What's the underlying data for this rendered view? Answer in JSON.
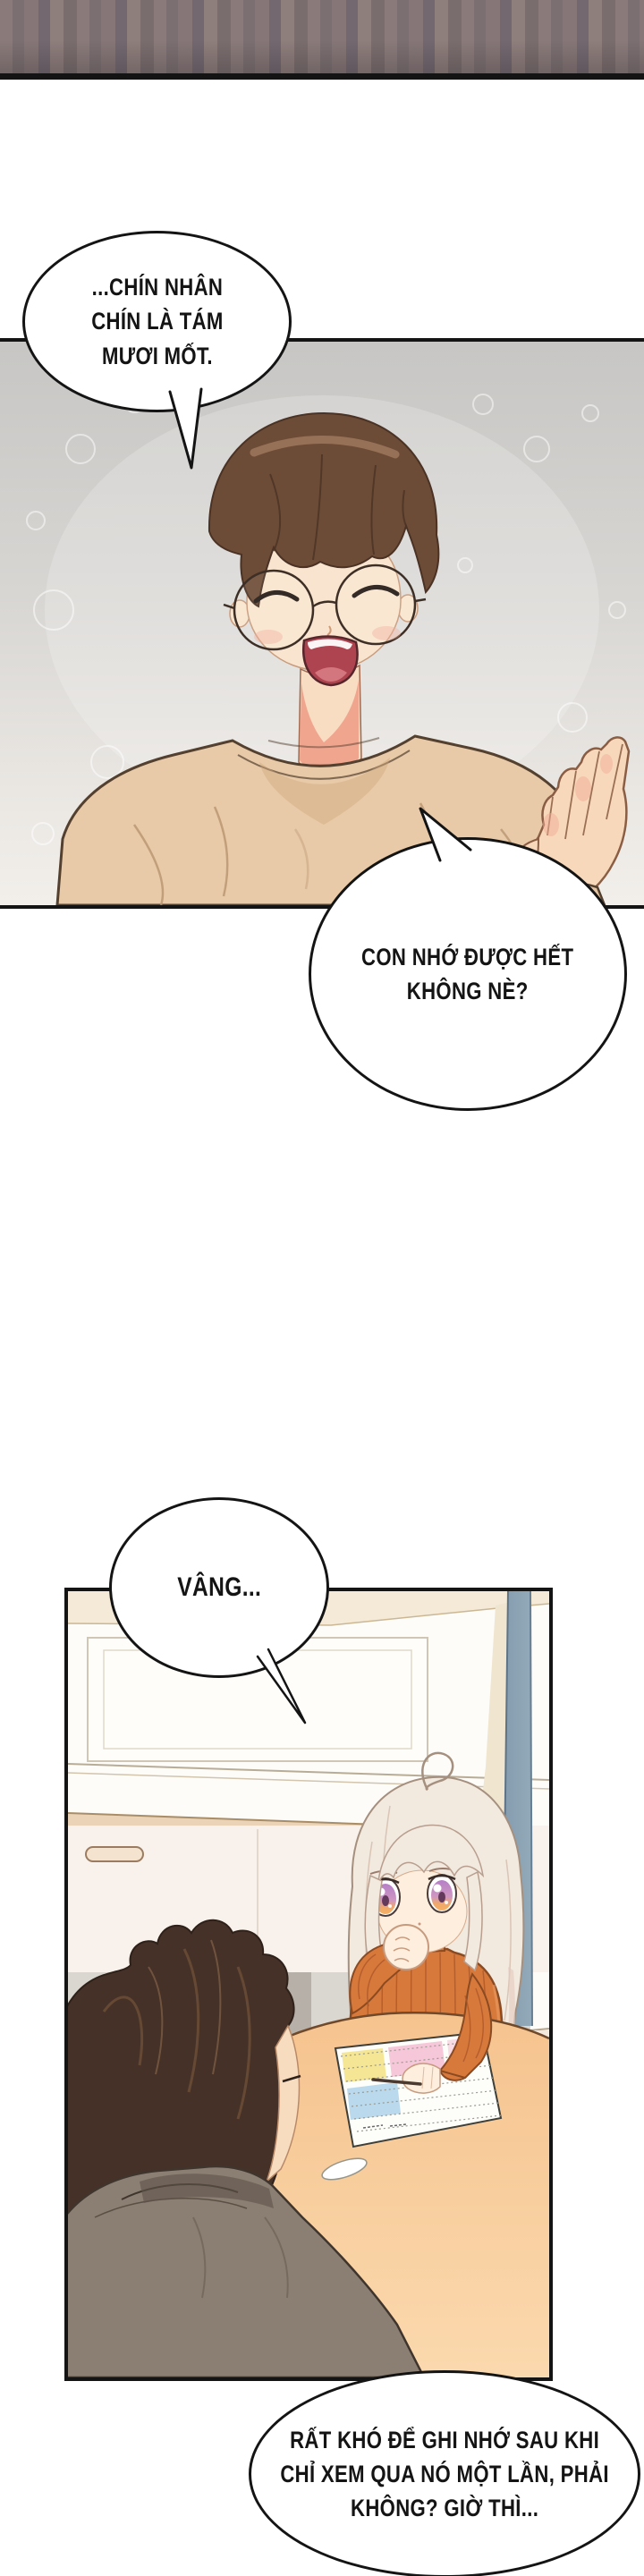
{
  "page": {
    "kind": "comic-page",
    "panel_count": 2,
    "bubble_count": 4
  },
  "dialogue": {
    "bubbles": [
      {
        "id": "bubble-1",
        "lines": [
          "...CHÍN NHÂN",
          "CHÍN LÀ TÁM",
          "MƯƠI MỐT."
        ]
      },
      {
        "id": "bubble-2",
        "lines": [
          "CON NHỚ ĐƯỢC HẾT",
          "KHÔNG NÈ?"
        ]
      },
      {
        "id": "bubble-3",
        "lines": [
          "VÂNG..."
        ]
      },
      {
        "id": "bubble-4",
        "lines": [
          "RẤT KHÓ ĐỂ GHI NHỚ SAU KHI",
          "CHỈ XEM QUA NÓ MỘT LẦN, PHẢI",
          "KHÔNG? GIỜ THÌ..."
        ]
      }
    ]
  },
  "colors": {
    "ink": "#141414",
    "bubble_fill": "#ffffff",
    "page_bg": "#ffffff",
    "top_band": "#81737a",
    "panel1_bg_top": "#c7c6c4",
    "panel1_bg_bottom": "#f2efeb",
    "father_hair": "#6d4c37",
    "father_sweater": "#e8caa8",
    "skin": "#f8ddc2",
    "neck_shadow": "#ee9e8a",
    "mouth": "#ae4450",
    "kitchen_cream": "#f4ead7",
    "counter": "#ead3b7",
    "pole_blue": "#869cb0",
    "table_peach": "#f7c795",
    "child_hair": "#f2e9df",
    "child_sweater": "#d8793c",
    "child_iris_top": "#b57fc8",
    "child_iris_bottom": "#f6b063",
    "man_back_hair": "#453127",
    "man_shirt": "#8b7e73",
    "sheet_yellow": "#f2e07c",
    "sheet_pink": "#f4b9cf",
    "sheet_blue": "#a9cfe8"
  }
}
